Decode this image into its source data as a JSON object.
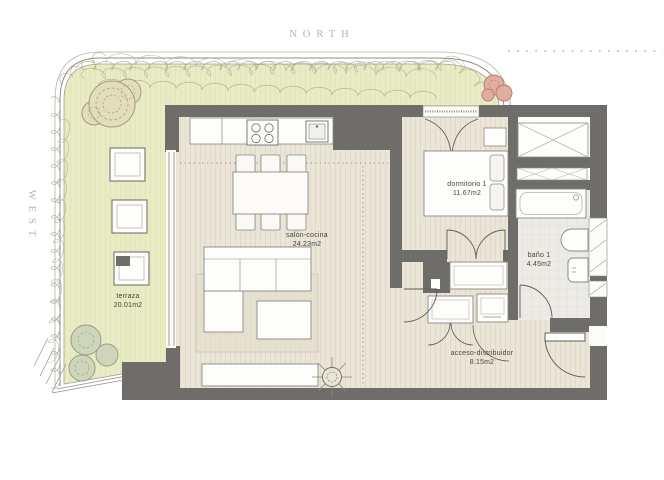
{
  "compass": {
    "north": "NORTH",
    "west": "WEST"
  },
  "rooms": {
    "terraza": {
      "name": "terraza",
      "area": "20.01m2"
    },
    "salon_cocina": {
      "name": "salón-cocina",
      "area": "24.23m2"
    },
    "dormitorio_1": {
      "name": "dormitorio 1",
      "area": "11.67m2"
    },
    "bano_1": {
      "name": "baño 1",
      "area": "4.45m2"
    },
    "acceso": {
      "name": "acceso-distribuidor",
      "area": "8.15m2"
    }
  },
  "colors": {
    "wall": "#6e6d6a",
    "terrace": "#e8ebc4",
    "wood_floor": "#eae5d7",
    "tile_floor": "#edebe6",
    "compass_text": "#b5b2a9",
    "label_text": "#44433d"
  }
}
